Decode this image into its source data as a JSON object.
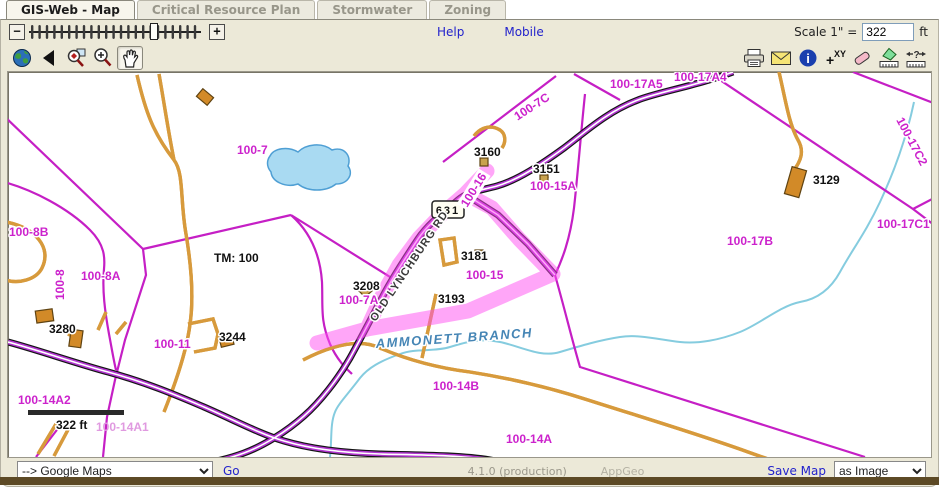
{
  "tabs": [
    {
      "label": "GIS-Web - Map",
      "active": true
    },
    {
      "label": "Critical Resource Plan",
      "active": false
    },
    {
      "label": "Stormwater",
      "active": false
    },
    {
      "label": "Zoning",
      "active": false
    }
  ],
  "controls": {
    "zoom_out": "−",
    "zoom_in": "+",
    "help": "Help",
    "mobile": "Mobile",
    "scale_prefix": "Scale 1\" =",
    "scale_value": "322",
    "scale_unit": "ft"
  },
  "toolbar_left": [
    "globe-icon",
    "back-arrow-icon",
    "zoom-extent-icon",
    "zoom-in-icon",
    "pan-hand-icon"
  ],
  "toolbar_right": [
    "print-icon",
    "email-icon",
    "info-icon",
    "xy-coordinates-icon",
    "eraser-icon",
    "measure-area-icon",
    "measure-distance-icon"
  ],
  "icons": {
    "xy_text": "XY",
    "xy_plus": "+",
    "info_i": "i",
    "measure_query": "?"
  },
  "colors": {
    "highlight_pink": "#ff4df2",
    "parcel_magenta": "#c51fc5",
    "road_purple": "#b135cf",
    "water_blue": "#85ccdf",
    "driveway_orange": "#d79a3c",
    "link_blue": "#2222cc"
  },
  "map": {
    "route_shield": "631",
    "scalebar_label": "322 ft",
    "labels": [
      {
        "text": "100-7",
        "x": 229,
        "y": 82,
        "type": "parcel"
      },
      {
        "text": "100-7C",
        "x": 526,
        "y": 38,
        "rot": -33,
        "type": "parcel",
        "anchor": "middle"
      },
      {
        "text": "100-17A5",
        "x": 602,
        "y": 16,
        "type": "parcel"
      },
      {
        "text": "100-17A4",
        "x": 666,
        "y": 9,
        "type": "parcel"
      },
      {
        "text": "100-15A",
        "x": 522,
        "y": 118,
        "type": "parcel"
      },
      {
        "text": "100-16",
        "x": 469,
        "y": 120,
        "rot": -58,
        "type": "parcel",
        "anchor": "middle",
        "boxed": true
      },
      {
        "text": "100-15",
        "x": 458,
        "y": 207,
        "type": "parcel"
      },
      {
        "text": "100-7A",
        "x": 331,
        "y": 232,
        "type": "parcel"
      },
      {
        "text": "100-17B",
        "x": 719,
        "y": 173,
        "type": "parcel"
      },
      {
        "text": "100-17C1",
        "x": 869,
        "y": 156,
        "type": "parcel"
      },
      {
        "text": "100-17C2",
        "x": 888,
        "y": 48,
        "rot": 62,
        "type": "parcel"
      },
      {
        "text": "100-8B",
        "x": 1,
        "y": 164,
        "type": "parcel"
      },
      {
        "text": "100-8",
        "x": 56,
        "y": 228,
        "rot": -90,
        "type": "parcel"
      },
      {
        "text": "100-8A",
        "x": 73,
        "y": 208,
        "type": "parcel"
      },
      {
        "text": "100-11",
        "x": 146,
        "y": 276,
        "type": "parcel"
      },
      {
        "text": "100-14A2",
        "x": 10,
        "y": 332,
        "type": "parcel"
      },
      {
        "text": "100-14A1",
        "x": 88,
        "y": 359,
        "type": "faded"
      },
      {
        "text": "100-14B",
        "x": 425,
        "y": 318,
        "type": "parcel"
      },
      {
        "text": "100-14A",
        "x": 498,
        "y": 371,
        "type": "parcel"
      },
      {
        "text": "3160",
        "x": 466,
        "y": 84,
        "type": "site"
      },
      {
        "text": "3151",
        "x": 525,
        "y": 101,
        "type": "site"
      },
      {
        "text": "3129",
        "x": 805,
        "y": 112,
        "type": "site"
      },
      {
        "text": "3181",
        "x": 453,
        "y": 188,
        "type": "site"
      },
      {
        "text": "3193",
        "x": 430,
        "y": 231,
        "type": "site"
      },
      {
        "text": "3208",
        "x": 345,
        "y": 218,
        "type": "site"
      },
      {
        "text": "3280",
        "x": 41,
        "y": 261,
        "type": "site"
      },
      {
        "text": "3244",
        "x": 211,
        "y": 269,
        "type": "site"
      },
      {
        "text": "TM: 100",
        "x": 206,
        "y": 190,
        "type": "site"
      },
      {
        "text": "AMMONETT BRANCH",
        "x": 368,
        "y": 276,
        "rot": -4,
        "type": "water"
      },
      {
        "text": "OLD LYNCHBURG RD",
        "x": 404,
        "y": 196,
        "rot": -56,
        "type": "road",
        "anchor": "middle"
      }
    ]
  },
  "footer": {
    "goto_value": "--> Google Maps",
    "go": "Go",
    "version": "4.1.0 (production)",
    "brand": "AppGeo",
    "save_map": "Save Map",
    "save_as_value": "as Image"
  }
}
